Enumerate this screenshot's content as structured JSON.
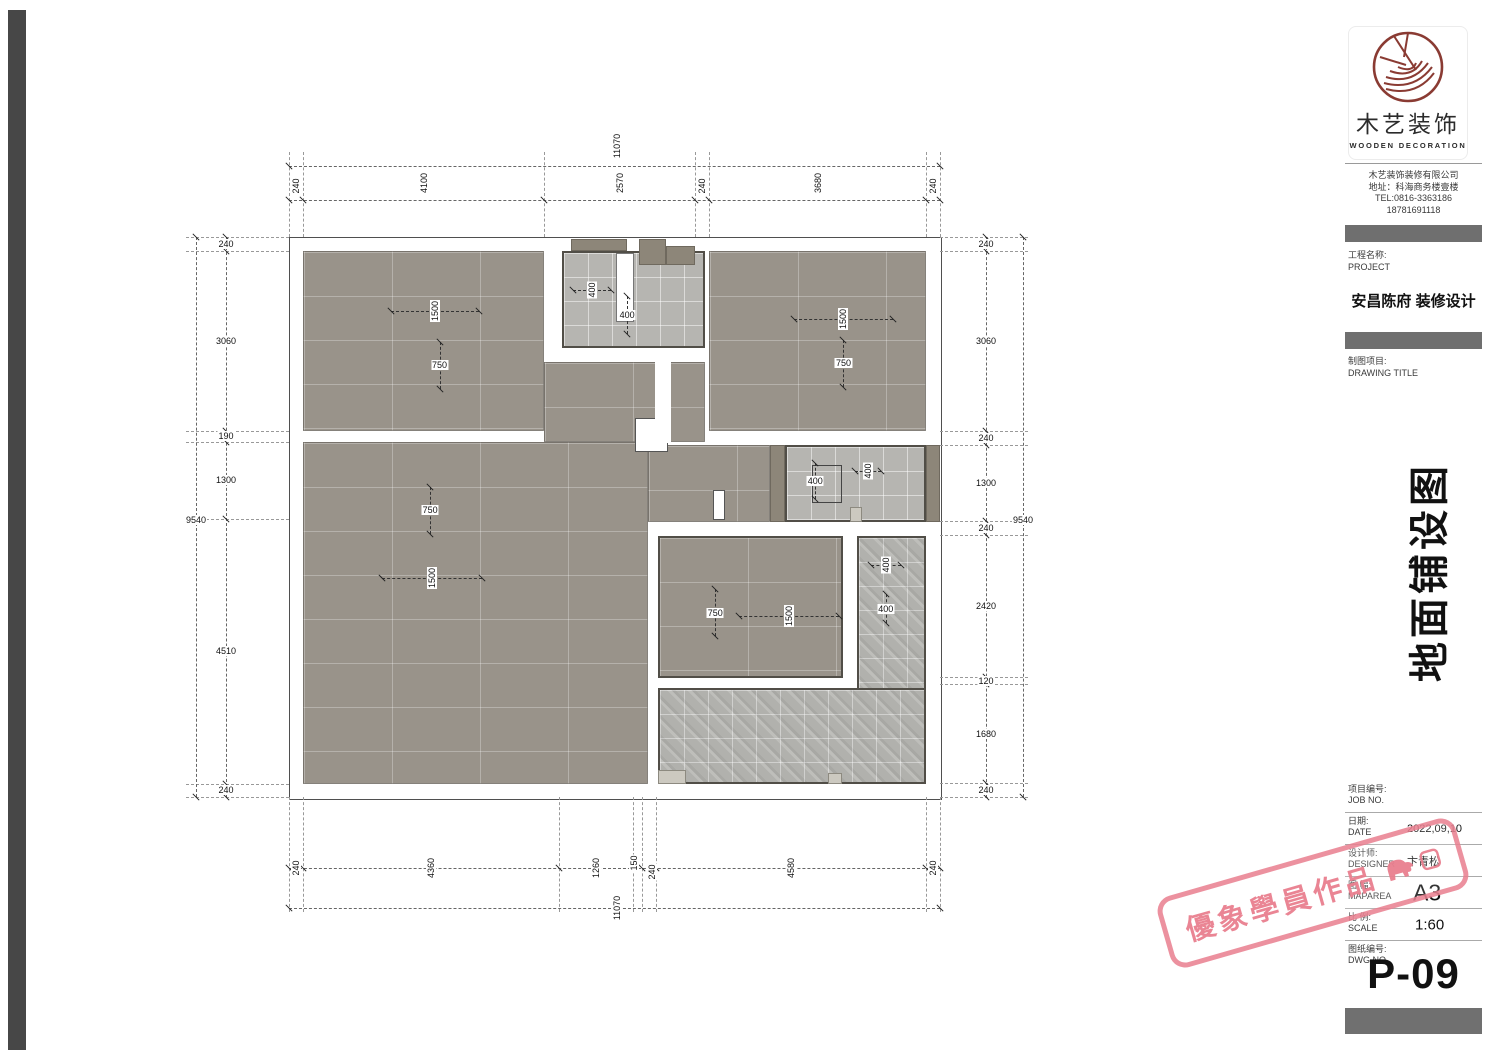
{
  "titleblock": {
    "logo": {
      "brand_cn": "木艺装饰",
      "brand_en": "WOODEN DECORATION"
    },
    "company": {
      "name": "木艺装饰装修有限公司",
      "address": "地址：科海商务楼壹楼",
      "tel": "TEL:0816-3363186",
      "tel2": "18781691118"
    },
    "project": {
      "label_cn": "工程名称:",
      "label_en": "PROJECT",
      "name": "安昌陈府 装修设计"
    },
    "drawing": {
      "label_cn": "制图项目:",
      "label_en": "DRAWING TITLE",
      "title_vertical": "地面铺设图"
    },
    "meta": [
      {
        "cn": "项目编号:",
        "en": "JOB NO.",
        "value": "",
        "size": "small"
      },
      {
        "cn": "日期:",
        "en": "DATE",
        "value": "2022,09,10",
        "size": "small"
      },
      {
        "cn": "设计师:",
        "en": "DESIGNER",
        "value": "卞青松",
        "size": "small"
      },
      {
        "cn": "图 幅:",
        "en": "MAPAREA",
        "value": "A3",
        "size": "big"
      },
      {
        "cn": "比 例:",
        "en": "SCALE",
        "value": "1:60",
        "size": "mid"
      },
      {
        "cn": "图纸编号:",
        "en": "DWG NO.",
        "value": "",
        "size": "small"
      }
    ],
    "dwg_no": "P-09"
  },
  "watermark": {
    "text": "優象學員作品",
    "color": "#e97e8e"
  },
  "plan": {
    "px_per_mm": 0.0588,
    "origin": {
      "x": 289,
      "y": 237
    },
    "size_mm": {
      "w": 11070,
      "h": 9540
    },
    "colors": {
      "tile_dark": "#99938a",
      "tile_light": "#b6b5b1",
      "wall_fill": "#8d8679",
      "threshold": "#ccc9c0"
    },
    "rooms": [
      {
        "id": "bedroom-top-left",
        "x": 240,
        "y": 240,
        "w": 4100,
        "h": 3060,
        "finish": "dark"
      },
      {
        "id": "bath-top",
        "x": 4650,
        "y": 240,
        "w": 2420,
        "h": 1650,
        "finish": "light",
        "outlined": true
      },
      {
        "id": "bedroom-top-right",
        "x": 7150,
        "y": 240,
        "w": 3680,
        "h": 3060,
        "finish": "dark"
      },
      {
        "id": "hall-upper",
        "x": 4340,
        "y": 2130,
        "w": 2730,
        "h": 1360,
        "finish": "dark"
      },
      {
        "id": "living-dining",
        "x": 240,
        "y": 3490,
        "w": 5860,
        "h": 5810,
        "finish": "dark"
      },
      {
        "id": "hall-right",
        "x": 6100,
        "y": 3540,
        "w": 2080,
        "h": 1300,
        "finish": "dark"
      },
      {
        "id": "bedroom-middle",
        "x": 6280,
        "y": 5080,
        "w": 3140,
        "h": 2420,
        "finish": "dark",
        "outlined": true
      },
      {
        "id": "bath-right",
        "x": 8440,
        "y": 3540,
        "w": 2390,
        "h": 1300,
        "finish": "light",
        "outlined": true
      },
      {
        "id": "balcony-side",
        "x": 9660,
        "y": 5080,
        "w": 1170,
        "h": 4220,
        "finish": "texture",
        "outlined": true
      },
      {
        "id": "balcony-bottom",
        "x": 6280,
        "y": 7670,
        "w": 4550,
        "h": 1630,
        "finish": "texture",
        "outlined": true
      }
    ],
    "wall_blocks": [
      {
        "x": 4800,
        "y": 30,
        "w": 950,
        "h": 210
      },
      {
        "x": 5950,
        "y": 30,
        "w": 460,
        "h": 450
      },
      {
        "x": 6420,
        "y": 160,
        "w": 490,
        "h": 320
      },
      {
        "x": 8180,
        "y": 3540,
        "w": 260,
        "h": 1300
      },
      {
        "x": 10830,
        "y": 3540,
        "w": 240,
        "h": 1300
      }
    ],
    "thresholds": [
      {
        "x": 6280,
        "y": 9060,
        "w": 470,
        "h": 250
      },
      {
        "x": 9160,
        "y": 9120,
        "w": 250,
        "h": 190
      },
      {
        "x": 9540,
        "y": 4600,
        "w": 210,
        "h": 240
      }
    ],
    "fixtures": [
      {
        "id": "bath-fixture",
        "x": 5560,
        "y": 270,
        "w": 300,
        "h": 1180,
        "fill": "#ffffff",
        "border": "#777"
      },
      {
        "id": "door-landing",
        "x": 5880,
        "y": 3080,
        "w": 560,
        "h": 580,
        "fill": "#ffffff",
        "border": "#555"
      },
      {
        "id": "door-mid",
        "x": 7210,
        "y": 4300,
        "w": 200,
        "h": 520,
        "fill": "#ffffff",
        "border": "#555"
      },
      {
        "id": "hall-strip",
        "x": 6230,
        "y": 2130,
        "w": 260,
        "h": 1370,
        "fill": "#ffffff"
      },
      {
        "id": "tile-indicator",
        "x": 8900,
        "y": 3880,
        "w": 500,
        "h": 650,
        "border": "#444"
      }
    ],
    "tile_marks": [
      {
        "t": "1500",
        "cx": 2483,
        "cy": 1250,
        "dir": "h",
        "len": 1500,
        "rot": true
      },
      {
        "t": "750",
        "cx": 2560,
        "cy": 2180,
        "dir": "v",
        "len": 800,
        "rot": false
      },
      {
        "t": "400",
        "cx": 5150,
        "cy": 900,
        "dir": "h",
        "len": 650,
        "rot": true
      },
      {
        "t": "400",
        "cx": 5750,
        "cy": 1320,
        "dir": "v",
        "len": 650,
        "rot": false
      },
      {
        "t": "1500",
        "cx": 9430,
        "cy": 1400,
        "dir": "h",
        "len": 1700,
        "rot": true
      },
      {
        "t": "750",
        "cx": 9430,
        "cy": 2150,
        "dir": "v",
        "len": 800,
        "rot": false
      },
      {
        "t": "750",
        "cx": 2400,
        "cy": 4650,
        "dir": "v",
        "len": 800,
        "rot": false
      },
      {
        "t": "1500",
        "cx": 2430,
        "cy": 5800,
        "dir": "h",
        "len": 1700,
        "rot": true
      },
      {
        "t": "400",
        "cx": 8950,
        "cy": 4150,
        "dir": "v",
        "len": 600,
        "rot": false
      },
      {
        "t": "400",
        "cx": 9850,
        "cy": 3980,
        "dir": "h",
        "len": 450,
        "rot": true
      },
      {
        "t": "750",
        "cx": 7250,
        "cy": 6390,
        "dir": "v",
        "len": 800,
        "rot": false
      },
      {
        "t": "1500",
        "cx": 8500,
        "cy": 6440,
        "dir": "h",
        "len": 1700,
        "rot": true
      },
      {
        "t": "400",
        "cx": 10150,
        "cy": 5570,
        "dir": "h",
        "len": 500,
        "rot": true
      },
      {
        "t": "400",
        "cx": 10150,
        "cy": 6320,
        "dir": "v",
        "len": 500,
        "rot": false
      }
    ],
    "chains": [
      {
        "dir": "h",
        "x": 289,
        "y": 166,
        "len": 651,
        "ticks": [
          289,
          940
        ],
        "labels": [
          {
            "t": "11070",
            "x": 617,
            "y": 146,
            "rot": true
          }
        ]
      },
      {
        "dir": "h",
        "x": 289,
        "y": 200,
        "len": 651,
        "ticks": [
          289,
          303,
          544,
          695,
          709,
          926,
          940
        ],
        "labels": [
          {
            "t": "240",
            "x": 296,
            "y": 186,
            "rot": true
          },
          {
            "t": "4100",
            "x": 424,
            "y": 183,
            "rot": true
          },
          {
            "t": "2570",
            "x": 620,
            "y": 183,
            "rot": true
          },
          {
            "t": "240",
            "x": 702,
            "y": 186,
            "rot": true
          },
          {
            "t": "3680",
            "x": 818,
            "y": 183,
            "rot": true
          },
          {
            "t": "240",
            "x": 933,
            "y": 186,
            "rot": true
          }
        ]
      },
      {
        "dir": "v",
        "x": 196,
        "y": 237,
        "len": 560,
        "ticks": [
          237,
          797
        ],
        "labels": [
          {
            "t": "9540",
            "x": 196,
            "y": 520,
            "rot": false
          }
        ]
      },
      {
        "dir": "v",
        "x": 226,
        "y": 237,
        "len": 560,
        "ticks": [
          237,
          251,
          431,
          442,
          519,
          784,
          797
        ],
        "labels": [
          {
            "t": "240",
            "x": 226,
            "y": 244,
            "rot": false
          },
          {
            "t": "3060",
            "x": 226,
            "y": 341,
            "rot": false
          },
          {
            "t": "190",
            "x": 226,
            "y": 436,
            "rot": false
          },
          {
            "t": "1300",
            "x": 226,
            "y": 480,
            "rot": false
          },
          {
            "t": "4510",
            "x": 226,
            "y": 651,
            "rot": false
          },
          {
            "t": "240",
            "x": 226,
            "y": 790,
            "rot": false
          }
        ]
      },
      {
        "dir": "v",
        "x": 986,
        "y": 237,
        "len": 560,
        "ticks": [
          237,
          251,
          431,
          445,
          521,
          535,
          677,
          684,
          783,
          797
        ],
        "labels": [
          {
            "t": "240",
            "x": 986,
            "y": 244,
            "rot": false
          },
          {
            "t": "3060",
            "x": 986,
            "y": 341,
            "rot": false
          },
          {
            "t": "240",
            "x": 986,
            "y": 438,
            "rot": false
          },
          {
            "t": "1300",
            "x": 986,
            "y": 483,
            "rot": false
          },
          {
            "t": "240",
            "x": 986,
            "y": 528,
            "rot": false
          },
          {
            "t": "2420",
            "x": 986,
            "y": 606,
            "rot": false
          },
          {
            "t": "120",
            "x": 986,
            "y": 681,
            "rot": false
          },
          {
            "t": "1680",
            "x": 986,
            "y": 734,
            "rot": false
          },
          {
            "t": "240",
            "x": 986,
            "y": 790,
            "rot": false
          }
        ]
      },
      {
        "dir": "v",
        "x": 1023,
        "y": 237,
        "len": 560,
        "ticks": [
          237,
          797
        ],
        "labels": [
          {
            "t": "9540",
            "x": 1023,
            "y": 520,
            "rot": false
          }
        ]
      },
      {
        "dir": "h",
        "x": 289,
        "y": 868,
        "len": 651,
        "ticks": [
          289,
          303,
          559,
          633,
          642,
          656,
          926,
          940
        ],
        "labels": [
          {
            "t": "240",
            "x": 296,
            "y": 868,
            "rot": true
          },
          {
            "t": "4360",
            "x": 431,
            "y": 868,
            "rot": true
          },
          {
            "t": "1260",
            "x": 596,
            "y": 868,
            "rot": true
          },
          {
            "t": "150",
            "x": 634,
            "y": 863,
            "rot": true
          },
          {
            "t": "240",
            "x": 652,
            "y": 872,
            "rot": true
          },
          {
            "t": "4580",
            "x": 791,
            "y": 868,
            "rot": true
          },
          {
            "t": "240",
            "x": 933,
            "y": 868,
            "rot": true
          }
        ]
      },
      {
        "dir": "h",
        "x": 289,
        "y": 908,
        "len": 651,
        "ticks": [
          289,
          940
        ],
        "labels": [
          {
            "t": "11070",
            "x": 617,
            "y": 908,
            "rot": true
          }
        ]
      }
    ],
    "stubs": {
      "top": {
        "xs": [
          289,
          303,
          544,
          695,
          709,
          926,
          940
        ],
        "y1": 152,
        "y2": 237
      },
      "bottom": {
        "xs": [
          289,
          303,
          559,
          633,
          642,
          656,
          926,
          940
        ],
        "y1": 797,
        "y2": 912
      },
      "left": {
        "ys": [
          237,
          251,
          431,
          442,
          519,
          784,
          797
        ],
        "x1": 186,
        "x2": 289
      },
      "right": {
        "ys": [
          237,
          251,
          431,
          445,
          521,
          535,
          677,
          684,
          783,
          797
        ],
        "x1": 940,
        "x2": 1028
      }
    }
  }
}
